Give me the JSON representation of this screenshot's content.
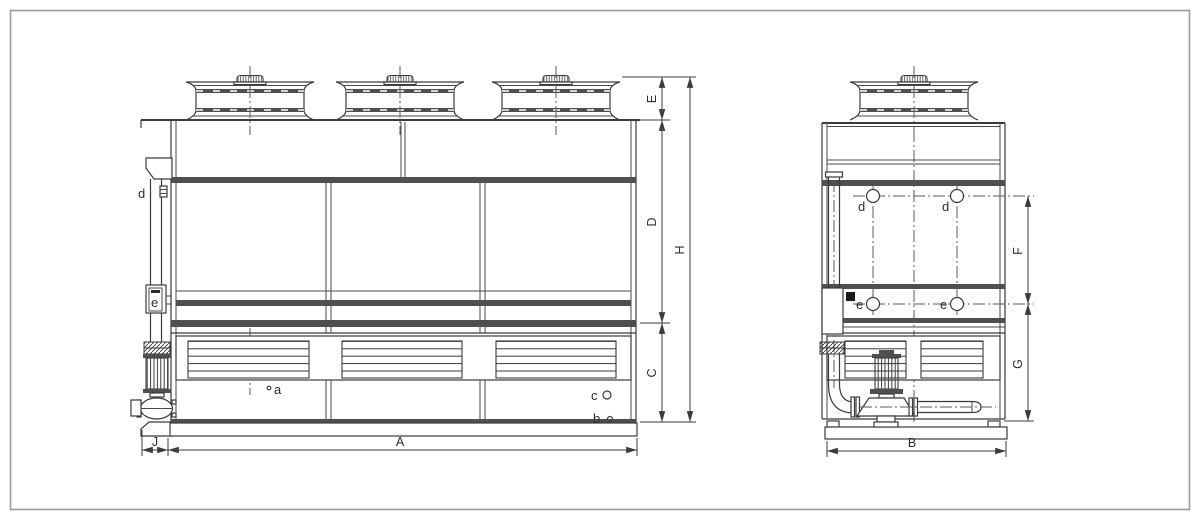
{
  "front_view": {
    "dims": {
      "E": "E",
      "D": "D",
      "C": "C",
      "H": "H",
      "J": "J",
      "A": "A"
    },
    "ports": {
      "d": "d",
      "e": "e",
      "a": "a",
      "b": "b",
      "c": "c"
    }
  },
  "side_view": {
    "dims": {
      "F": "F",
      "G": "G",
      "B": "B"
    },
    "ports": {
      "d_left": "d",
      "d_right": "d",
      "e_left": "e",
      "e_right": "e"
    }
  },
  "colors": {
    "line": "#3b3b3b",
    "band": "#4f4f4f",
    "background": "#ffffff",
    "frame_border": "#9a9a9a"
  }
}
